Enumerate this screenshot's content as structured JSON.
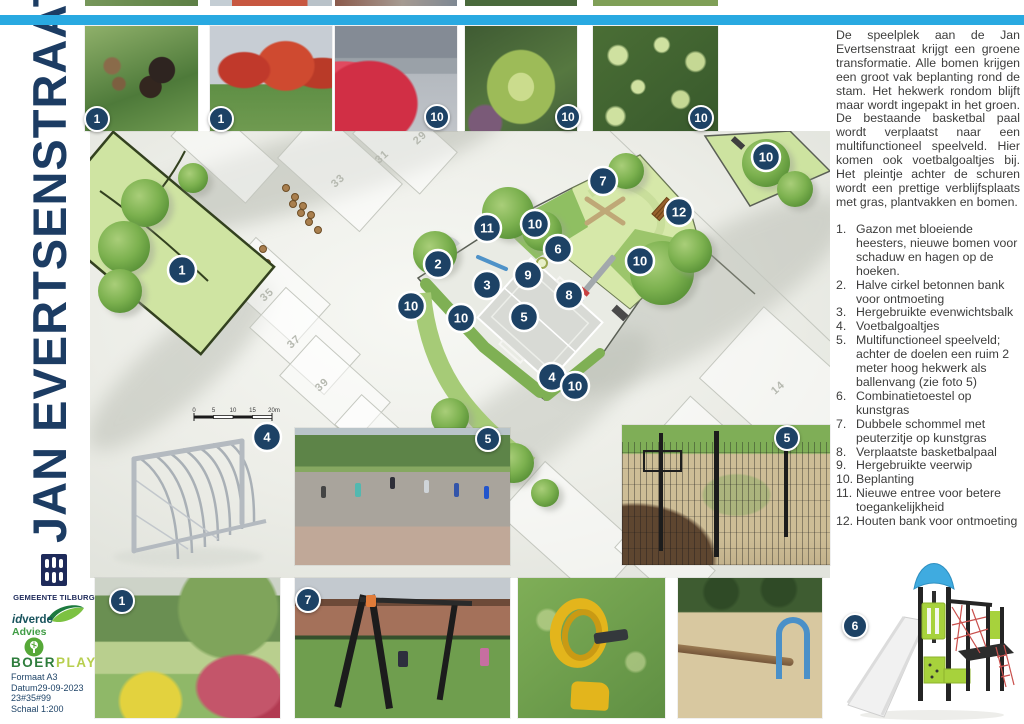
{
  "poster": {
    "title": "JAN EVERTSENSTRAAT",
    "intro": "De speelplek aan de Jan Evertsenstraat krijgt een groene transformatie. Alle bomen krijgen een groot vak beplanting rond de stam. Het hekwerk rondom blijft maar wordt ingepakt in het groen. De bestaande basketbal paal wordt verplaatst naar een multifunctioneel speelveld. Hier komen ook voetbalgoaltjes bij. Het pleintje achter de schuren wordt een prettige verblijfsplaats met gras, plantvakken en bomen."
  },
  "legend": [
    {
      "n": "1.",
      "t": "Gazon met bloeiende heesters, nieuwe bomen voor schaduw en hagen op de hoeken."
    },
    {
      "n": "2.",
      "t": "Halve cirkel betonnen bank voor ontmoeting"
    },
    {
      "n": "3.",
      "t": "Hergebruikte evenwichtsbalk"
    },
    {
      "n": "4.",
      "t": "Voetbalgoaltjes"
    },
    {
      "n": "5.",
      "t": "Multifunctioneel speelveld; achter de doelen een ruim 2 meter hoog hekwerk als ballenvang (zie foto 5)"
    },
    {
      "n": "6.",
      "t": "Combinatietoestel op kunstgras"
    },
    {
      "n": "7.",
      "t": "Dubbele schommel met peuterzitje op kunstgras"
    },
    {
      "n": "8.",
      "t": "Verplaatste basketbalpaal"
    },
    {
      "n": "9.",
      "t": "Hergebruikte veerwip"
    },
    {
      "n": "10.",
      "t": "Beplanting"
    },
    {
      "n": "11.",
      "t": "Nieuwe entree voor betere toegankelijkheid"
    },
    {
      "n": "12.",
      "t": "Houten bank voor ontmoeting"
    }
  ],
  "badges_photos": {
    "alder": "1",
    "maples": "1",
    "shrubs": "10",
    "bush": "10",
    "ivy": "10",
    "court": "5",
    "fence": "5",
    "park": "1",
    "swing": "7",
    "combi": "6",
    "goal": "4"
  },
  "map": {
    "badges": [
      "1",
      "2",
      "3",
      "4",
      "5",
      "6",
      "7",
      "8",
      "9",
      "10",
      "10",
      "10",
      "10",
      "10",
      "10",
      "11",
      "12"
    ],
    "parcels": [
      "29",
      "31",
      "33",
      "35",
      "37",
      "39",
      "14"
    ],
    "scale_ticks": [
      "0",
      "5",
      "10",
      "15",
      "20m"
    ]
  },
  "footer": {
    "org1": "GEMEENTE TILBURG",
    "org2_a": "id",
    "org2_b": "verde",
    "org2_c": "Advies",
    "org3_a": "BOER",
    "org3_b": "PLAY",
    "meta": [
      "Formaat A3",
      "Datum29-09-2023",
      "23#35#99",
      "Schaal 1:200"
    ]
  },
  "colors": {
    "top_bar": "#29a9e1",
    "badge": "#1d4265",
    "title": "#1c3c63",
    "field_green": "#d6e8a9",
    "tree_green": "#7cb14f"
  }
}
